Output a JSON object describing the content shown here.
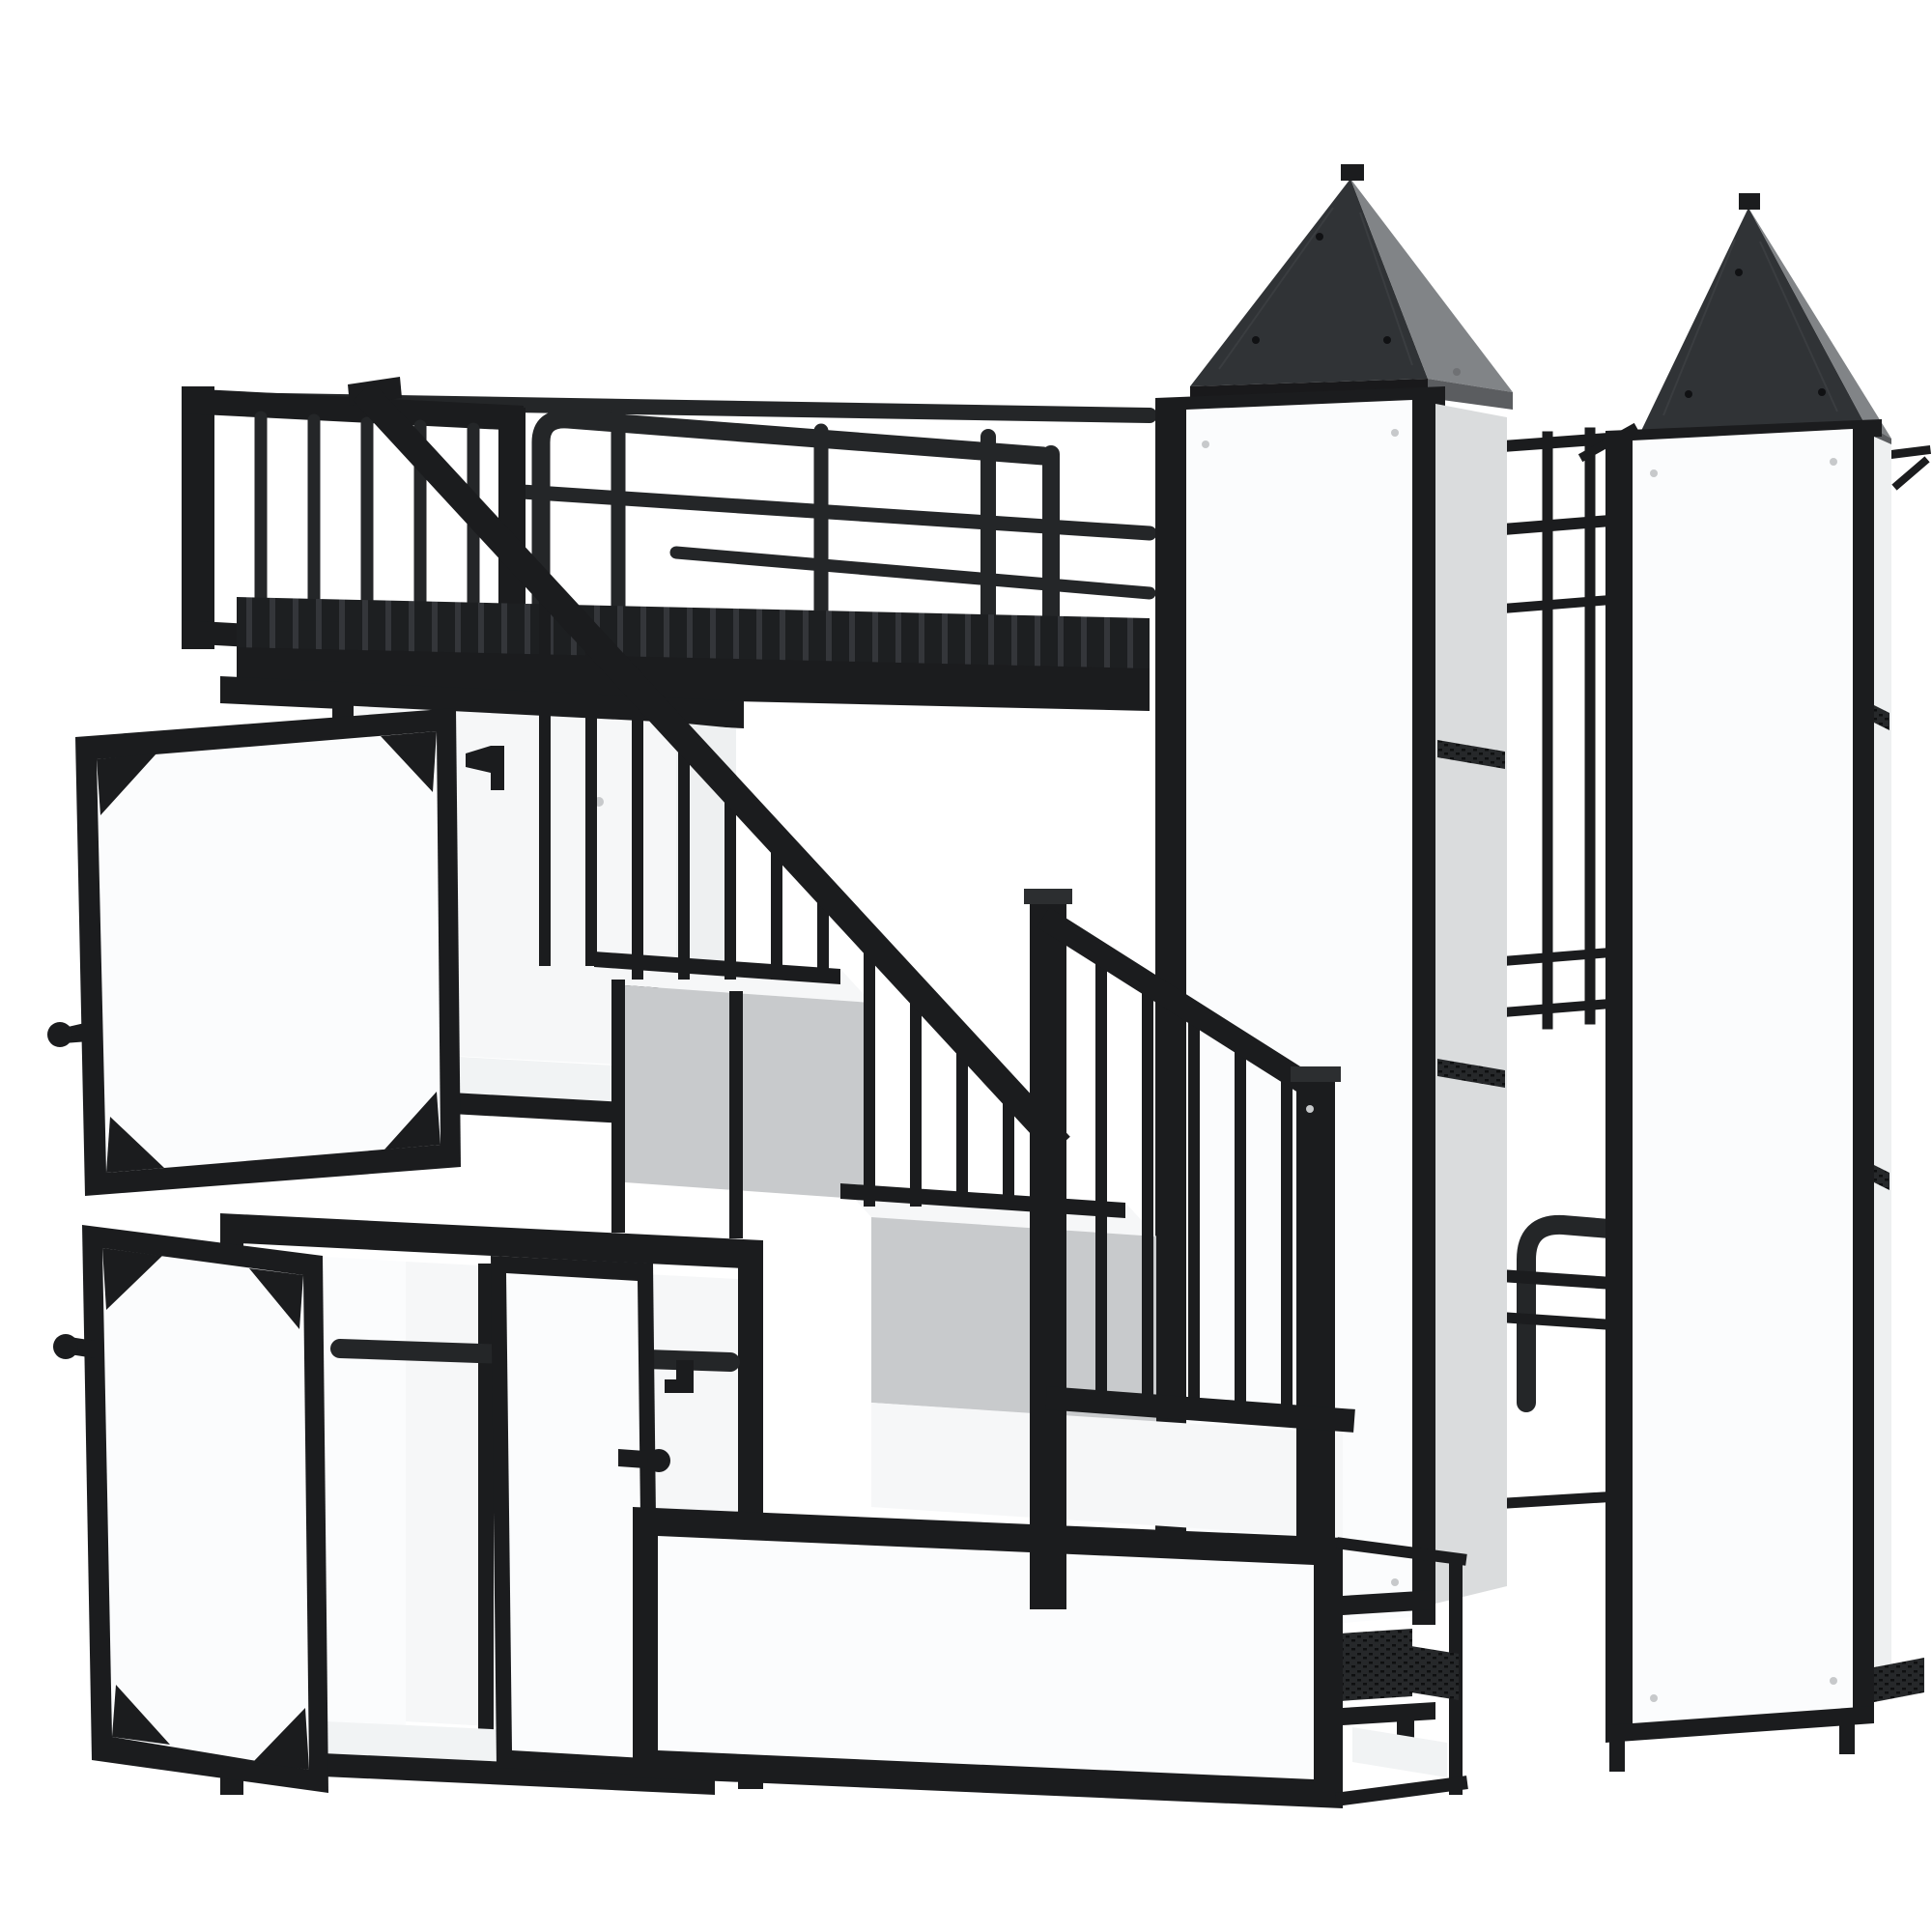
{
  "meta": {
    "title": "Castle-style metal loft bed with wardrobe, storage staircase and twin towers",
    "description": "3D product render on a white background: a black metal castle loft bed. Upper bed with slatted deck and tube guardrails at the top left, a long diagonal stair handrail with vertical balusters descending to storage steps, an open top cabinet and a wardrobe with open framed white doors and a hanging rod on the lower left, and two tall castle towers on the right with black pyramid roofs, white side panels and dark mesh shelves; a lower bed footboard is visible between the towers."
  },
  "colors": {
    "bg": "#ffffff",
    "frame": "#1b1c1e",
    "frame-light": "#2c2e30",
    "tube": "#242628",
    "roof-front": "#303336",
    "roof-side": "#818487",
    "roof-eave": "#19191b",
    "roof-eave-side": "#5b5d60",
    "panel": "#f6f7f8",
    "panel-bright": "#fbfcfd",
    "panel-inner": "#eef0f1",
    "panel-floor": "#f1f3f4",
    "panel-gray": "#c8cacc",
    "panel-gray2": "#dadcdd",
    "mesh-bg": "#26282a",
    "mesh-hole": "#0e0f10",
    "screw": "#c7c9cb",
    "rivet": "#101113",
    "rivet-side": "#6f7174",
    "seam": "#3a3d40"
  },
  "scene": {
    "parts": [
      {
        "name": "tower-left",
        "description": "tall turret, black pyramid roof with riveted seams, white front panel, inner mesh shelves"
      },
      {
        "name": "tower-right",
        "description": "tall turret, black pyramid roof, white front panel, floating mesh shelf under base"
      },
      {
        "name": "between-tower-guardrail",
        "description": "tube and slat guardrail visible in the gap between towers"
      },
      {
        "name": "upper-bed",
        "description": "loft bed with slatted metal deck, tube side rails and vertical-slat headboard guard"
      },
      {
        "name": "stair-handrail",
        "description": "steep diagonal handrail, corner post, shallow lower rail, newel post and square balusters"
      },
      {
        "name": "storage-steps",
        "description": "landing and step boxes with white tops, gray shadowed sides and framed white fronts"
      },
      {
        "name": "top-cabinet",
        "description": "open storage cubby with white interior and an open framed door with corner gussets and knob"
      },
      {
        "name": "wardrobe",
        "description": "open wardrobe with hanging rod, center divider, open left door and ajar right door with knobs"
      },
      {
        "name": "lower-bed-footboard",
        "description": "rounded-corner tube footboard of the lower bed seen between the towers"
      }
    ]
  }
}
